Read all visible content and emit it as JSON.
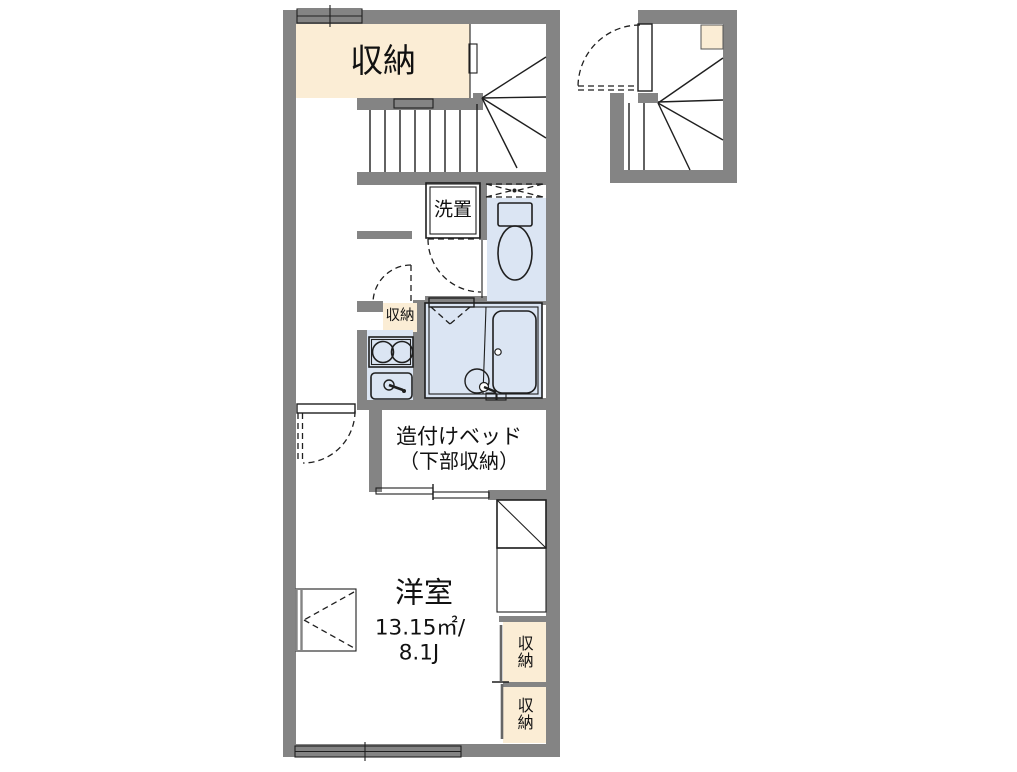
{
  "colors": {
    "wall": "#848484",
    "storage_fill": "#fbedd5",
    "wet_area_fill": "#dbe5f3",
    "fixture_fill": "#eef2fa",
    "line": "#1f1f1f",
    "background": "#ffffff",
    "text": "#111111"
  },
  "floorplan": {
    "labels": {
      "closet_top": "収納",
      "laundry_space": "洗置",
      "closet_hall": "収納",
      "built_in_bed_line1": "造付けベッド",
      "built_in_bed_line2": "（下部収納）",
      "room_name": "洋室",
      "room_area_sqm": "13.15㎡/",
      "room_area_tatami": "8.1J",
      "closet_right_upper": "収納",
      "closet_right_lower": "収納"
    }
  }
}
